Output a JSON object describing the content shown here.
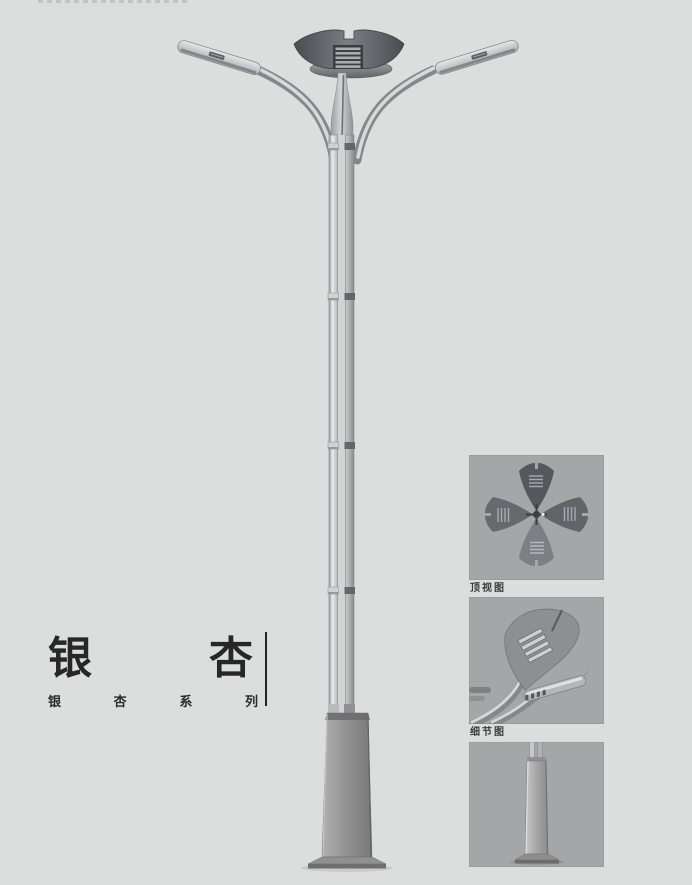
{
  "page": {
    "background_color": "#dcdddd"
  },
  "product": {
    "title": "银杏",
    "title_chars": [
      "银",
      "杏"
    ],
    "series_label": "银杏系列",
    "series_chars": [
      "银",
      "杏",
      "系",
      "列"
    ]
  },
  "detail_panels": {
    "items": [
      {
        "caption": "顶视图"
      },
      {
        "caption": "细节图"
      },
      {
        "caption": ""
      }
    ]
  },
  "colors": {
    "panel_background": "#a5a6a7",
    "text_primary": "#272727",
    "caption_text": "#3a3a3a",
    "metal_dark": "#54575b",
    "metal_mid": "#8e9194",
    "metal_light": "#d7d8d9"
  }
}
